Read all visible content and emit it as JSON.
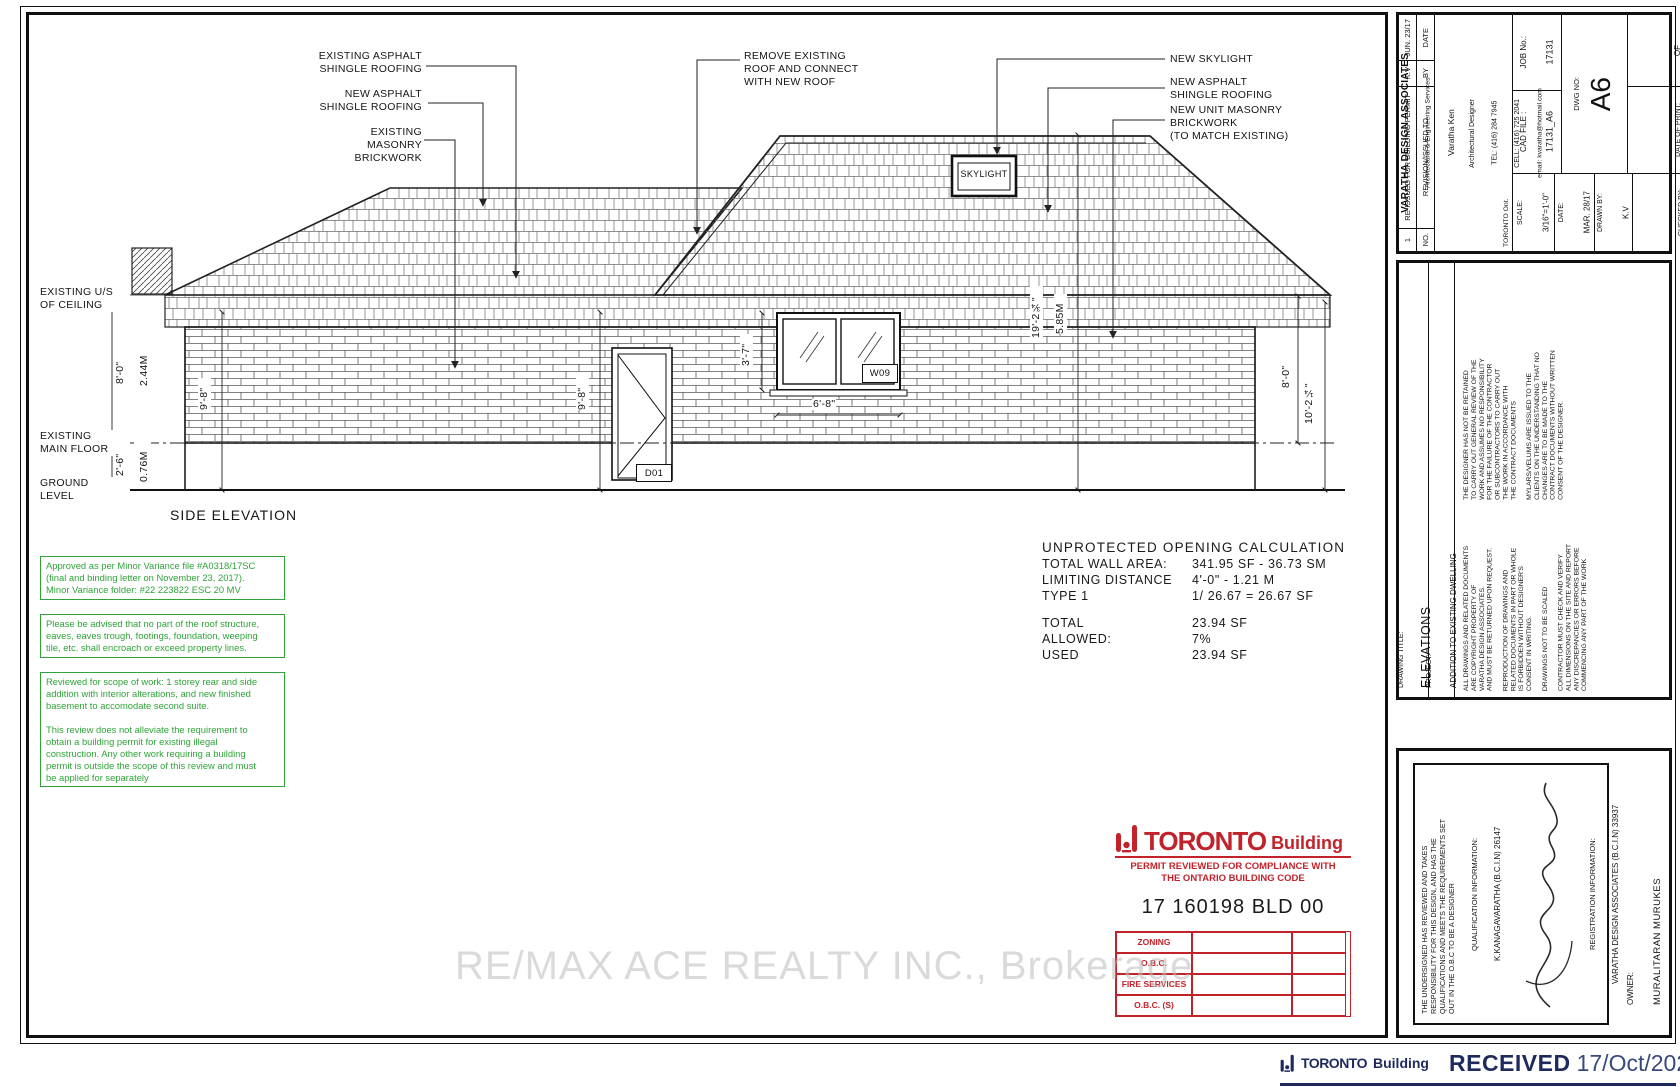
{
  "colors": {
    "stamp_green": "#2fa339",
    "stamp_red": "#c2232a",
    "received_navy": "#1e2a5e"
  },
  "drawing": {
    "caption": "SIDE ELEVATION",
    "callouts": {
      "existing_asphalt": "EXISTING ASPHALT\nSHINGLE ROOFING",
      "new_asphalt_left": "NEW ASPHALT\nSHINGLE ROOFING",
      "existing_masonry": "EXISTING MASONRY\nBRICKWORK",
      "remove_roof": "REMOVE EXISTING\nROOF AND CONNECT\nWITH NEW ROOF",
      "new_skylight": "NEW SKYLIGHT",
      "new_asphalt_right": "NEW ASPHALT\nSHINGLE ROOFING",
      "new_masonry": "NEW UNIT MASONRY\nBRICKWORK\n(TO MATCH EXISTING)"
    },
    "levels": {
      "ceiling": "EXISTING U/S\nOF CEILING",
      "main_floor": "EXISTING\nMAIN FLOOR",
      "ground": "GROUND\nLEVEL"
    },
    "dims": {
      "wall_ft": "8'-0\"",
      "wall_m": "2.44M",
      "base_ft": "2'-6\"",
      "base_m": "0.76M",
      "nine8a": "9'-8\"",
      "nine8b": "9'-8\"",
      "win_h": "3'-7\"",
      "win_w": "6'-8\"",
      "total_ft": "19'-2¾\"",
      "total_m": "5.85M",
      "right_ft": "8'-0\"",
      "right_total": "10'-2¼\""
    },
    "tags": {
      "skylight": "SKYLIGHT",
      "window": "W09",
      "door": "D01"
    }
  },
  "stamps": {
    "approval1": "Approved as per Minor Variance file #A0318/17SC\n(final and binding letter on November 23, 2017).\nMinor Variance folder: #22 223822 ESC 20 MV",
    "approval2": "Please be advised that no part of the roof structure,\neaves, eaves trough, footings, foundation, weeping\ntile, etc. shall encroach or exceed property lines.",
    "approval3": "Reviewed for scope of work:  1 storey rear and side\naddition with interior alterations, and new finished\nbasement to accomodate second suite.\n\nThis review does not alleviate the requirement to\nobtain a building permit for existing illegal\nconstruction.  Any other work requiring a building\npermit is outside the scope of this review and must\nbe applied for separately"
  },
  "calc": {
    "title": "UNPROTECTED OPENING CALCULATION",
    "rows": [
      {
        "label": "TOTAL WALL AREA:",
        "value": "341.95 SF - 36.73 SM"
      },
      {
        "label": "LIMITING DISTANCE",
        "value": "4'-0\" - 1.21 M"
      },
      {
        "label": "TYPE 1",
        "value": "1/ 26.67 = 26.67 SF"
      },
      {
        "label": "TOTAL",
        "value": "23.94 SF"
      },
      {
        "label": "ALLOWED:",
        "value": "7%"
      },
      {
        "label": "USED",
        "value": "23.94 SF"
      }
    ]
  },
  "toronto_stamp": {
    "brand": "TORONTO",
    "suffix": "Building",
    "line1": "PERMIT REVIEWED FOR COMPLIANCE WITH",
    "line2": "THE ONTARIO BUILDING CODE",
    "permit_no": "17 160198 BLD 00",
    "rows": [
      "ZONING",
      "O.B.C.",
      "FIRE SERVICES",
      "O.B.C. (S)"
    ]
  },
  "received_stamp": {
    "brand": "TORONTO",
    "suffix": "Building",
    "word": "RECEIVED",
    "date": "17/Oct/2023"
  },
  "watermark": "RE/MAX ACE REALTY INC., Brokerage",
  "titleblock": {
    "revision": {
      "no": "1",
      "desc": "RE-ISSUED FOR BUILDING PERMIT",
      "by": "K.V",
      "date": "JUN. 23/17",
      "h_no": "NO.",
      "h_desc": "REVISION/ISSUED TO",
      "h_by": "BY",
      "h_date": "DATE"
    },
    "company": {
      "name": "VARATHA DESIGN ASSOCIATES",
      "services": "Architectural & Engineering Services",
      "person": "Varatha Ken",
      "role": "Architectural Designer",
      "tel": "TEL: (416) 284 7945",
      "cell": "CELL: (416) 725 2041",
      "email": "email: kvaratha@hotmail.com",
      "city": "TORONTO Ont."
    },
    "info": {
      "job_label": "JOB No.:",
      "job": "17131",
      "cad_label": "CAD FILE :",
      "cad": "17131_A6",
      "dwg_label": "DWG NO:",
      "dwg": "A6",
      "of_label": "OF",
      "sheets": "7",
      "print_label": "DATE OF PRINT:",
      "print_date": "JUN. 23/17",
      "scale_label": "SCALE:",
      "scale": "3/16\"=1'-0\"",
      "date_label": "DATE:",
      "date": "MAR. 28/17",
      "drawn_label": "DRAWN BY:",
      "drawn": "K.V",
      "checked_label": "CHECKED BY:",
      "checked": "K.V"
    },
    "titles": {
      "t_label": "DRAWING TITLE:",
      "title": "ELEVATIONS",
      "p_label": "PROJECT:",
      "project": "ADDITION  TO  EXISTING  DWELLING"
    },
    "disclaimers": {
      "top": "THE DESIGNER HAS NOT BE RETAINED\nTO CARRY OUT GENERAL REVIEW OF THE\nWORK AND ASSUMES NO RESPONSIBILITY\nFOR THE FAILURE OF THE CONTRACTOR\nOR SUBCONTRACTORS TO CARRY OUT\nTHE WORK IN ACCORDANCE WITH\nTHE CONTRACT DOCUMENTS\n\nMYLARS/VELUMS ARE ISSUED TO THE\nCLIENTS ON THE UNDERSTANDING THAT NO\nCHANGES ARE TO BE MADE TO THE\nCONTRACT DOCUMENTS WITHOUT WRITTEN\nCONSENT OF THE DESIGNER.",
      "bottom": "ALL DRAWINGS AND RELATED DOCUMENTS\nARE COPYRIGHT PROPERTY OF\nVARATHA DESIGN ASSOCIATES.\nAND MUST BE RETURNED UPON REQUEST.\n\nREPRODUCTION OF DRAWINGS AND\nRELATED DOCUMENTS IN PART OR WHOLE\nIS FORBIDDEN WITHOUT DESIGNER'S\nCONSENT IN WRITING.\n\nDRAWINGS NOT TO BE SCALED\n\nCONTRACTOR MUST CHECK AND VERIFY\nALL DIMENSIONS ON THE SITE AND REPORT\nANY DISCREPANCIES OR ERRORS BEFORE\nCOMMENCING ANY PART OF THE WORK"
    },
    "declaration": {
      "statement": "THE UNDERSIGNED HAS REVIEWED AND TAKES\nRESPONSIBILITY FOR THIS DESIGN, AND HAS THE\nQUALIFICATIONS AND MEETS THE REQUIREMENTS SET\nOUT IN THE O.B.C TO BE A DESIGNER",
      "qual_label": "QUALIFICATION INFORMATION:",
      "qual": "K.KANAGAVARATHA (B.C.I.N) 26147",
      "reg_label": "REGISTRATION INFORMATION:",
      "reg": "VARATHA DESIGN ASSOCIATES (B.C.I.N) 33937",
      "owner_label": "OWNER:",
      "owner": "MURALITARAN MURUKES"
    }
  }
}
